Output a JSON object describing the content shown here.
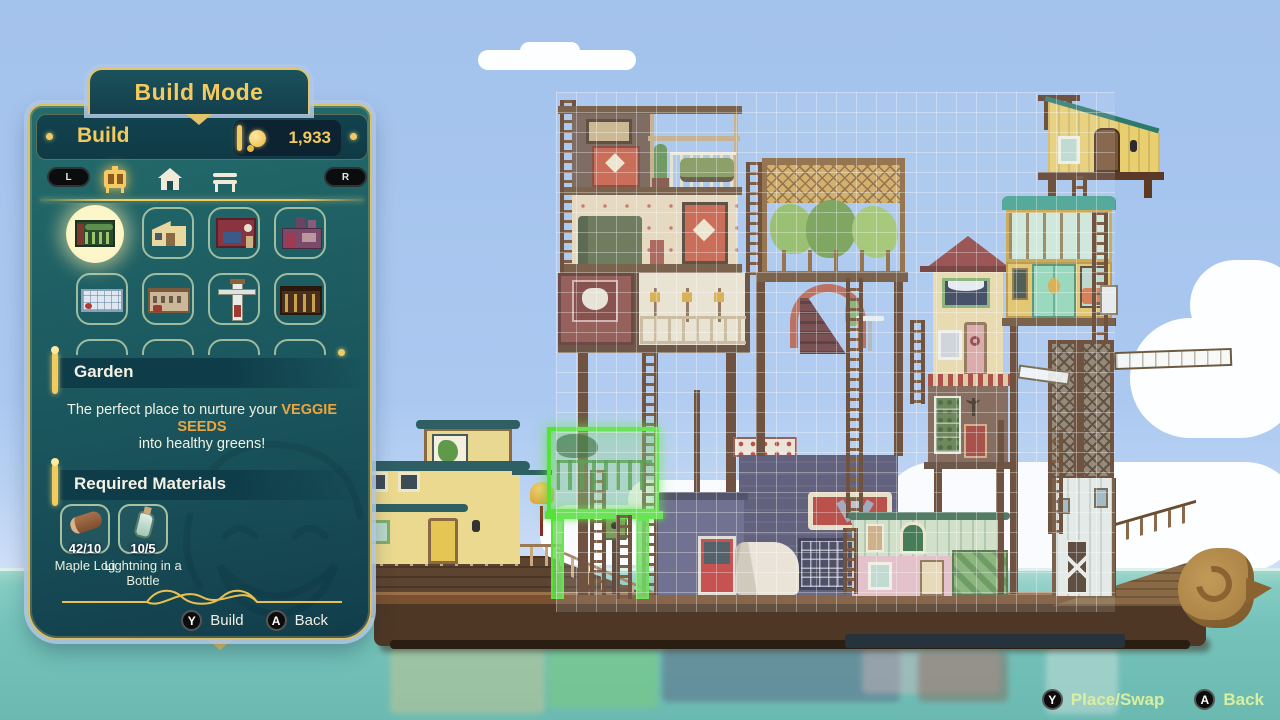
{
  "colors": {
    "accent_gold": "#f2ca5e",
    "panel_teal": "#1c5a60",
    "ghost_green": "#57e23a",
    "highlight_orange": "#eda63f",
    "hud_green": "#d9ef9f",
    "sky_blue": "#aac8f0",
    "water_teal": "#7cc7c0"
  },
  "title_tab": {
    "label": "Build Mode"
  },
  "panel": {
    "header": {
      "label": "Build",
      "currency": "1,933",
      "currency_icon": "glim-coin-icon"
    },
    "tabs": {
      "left_bumper": "L",
      "right_bumper": "R",
      "icons": [
        "buildings-tab-icon",
        "house-tab-icon",
        "furniture-tab-icon"
      ],
      "selected": "buildings-tab-icon"
    },
    "grid": {
      "items": [
        {
          "icon": "garden-thumb",
          "selected": true
        },
        {
          "icon": "small-house-thumb",
          "selected": false
        },
        {
          "icon": "bedroom-thumb",
          "selected": false
        },
        {
          "icon": "foundry-thumb",
          "selected": false
        },
        {
          "icon": "long-cabin-thumb",
          "selected": false
        },
        {
          "icon": "dining-hall-thumb",
          "selected": false
        },
        {
          "icon": "windmill-thumb",
          "selected": false
        },
        {
          "icon": "smithy-thumb",
          "selected": false
        }
      ]
    },
    "selection": {
      "name": "Garden",
      "desc_pre": "The perfect place to nurture your ",
      "desc_highlight": "VEGGIE SEEDS",
      "desc_post": "into healthy greens!"
    },
    "materials_header": "Required Materials",
    "materials": [
      {
        "name": "Maple Log",
        "count": "42/10",
        "icon": "maple-log-icon"
      },
      {
        "name": "Lightning in a Bottle",
        "count": "10/5",
        "icon": "lightning-bottle-icon"
      }
    ],
    "buttons": [
      {
        "key": "Y",
        "label": "Build"
      },
      {
        "key": "A",
        "label": "Back"
      }
    ]
  },
  "hud": {
    "buttons": [
      {
        "key": "Y",
        "label": "Place/Swap"
      },
      {
        "key": "A",
        "label": "Back"
      }
    ]
  }
}
